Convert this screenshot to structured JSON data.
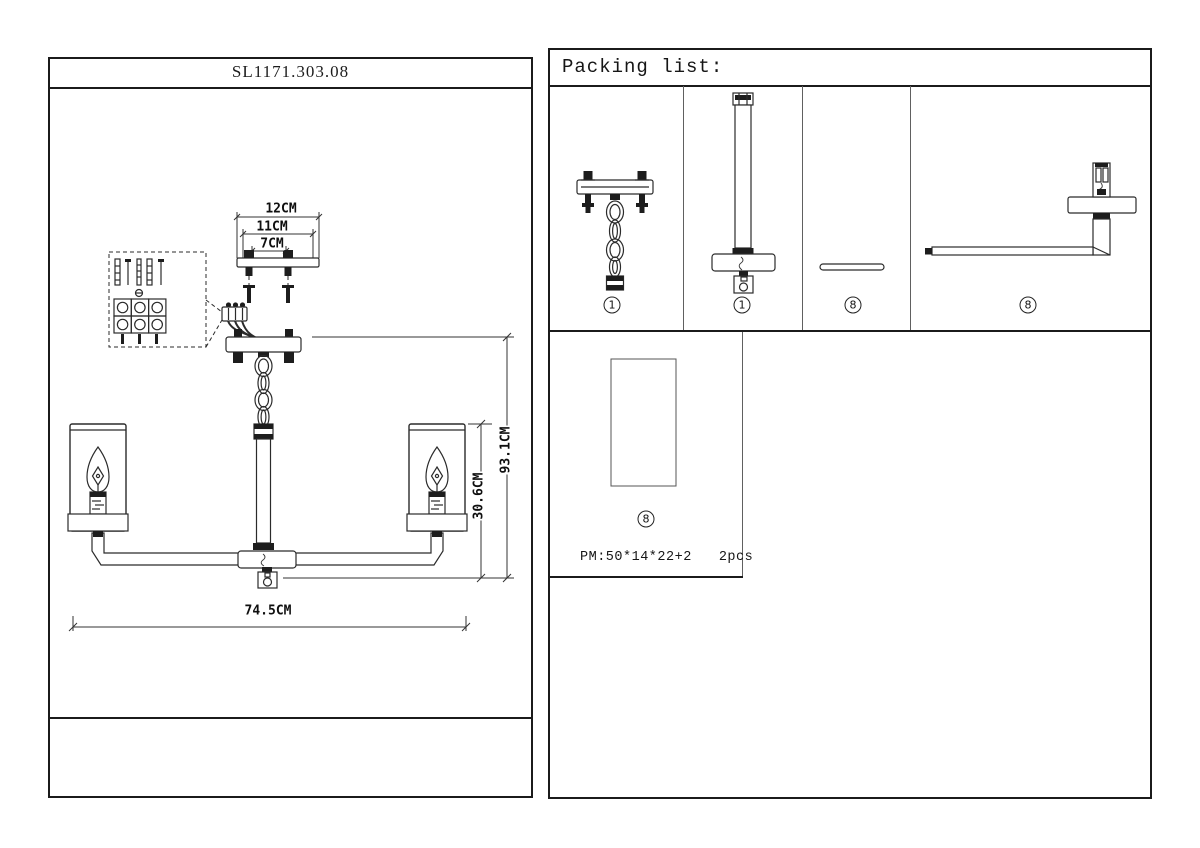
{
  "left_panel": {
    "title": "SL1171.303.08",
    "dimensions": {
      "bracket_outer": "12CM",
      "bracket_middle": "11CM",
      "bracket_holes": "7CM",
      "total_height": "93.1CM",
      "body_height": "30.6CM",
      "total_width": "74.5CM"
    }
  },
  "packing_list": {
    "title": "Packing list:",
    "items": [
      {
        "label": "1"
      },
      {
        "label": "1"
      },
      {
        "label": "8"
      },
      {
        "label": "8"
      }
    ],
    "carton": {
      "label": "8",
      "dimensions": "PM:50*14*22+2",
      "quantity": "2pcs"
    }
  }
}
